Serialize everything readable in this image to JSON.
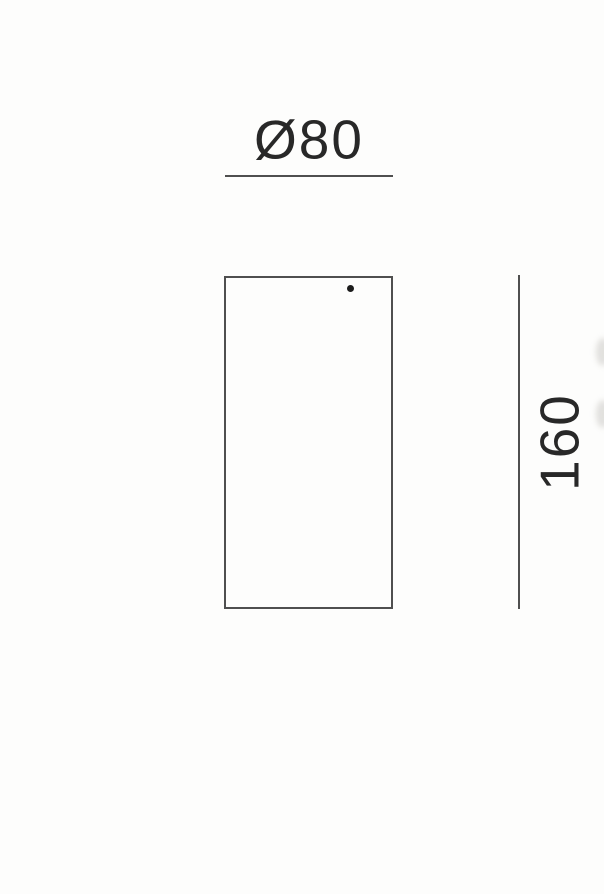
{
  "drawing": {
    "diameter": {
      "label": "Ø80"
    },
    "height": {
      "label": "160"
    }
  },
  "colors": {
    "background": "#fdfdfc",
    "line": "#4f4f4f",
    "text": "#282828",
    "dot": "#1c1c1c"
  }
}
